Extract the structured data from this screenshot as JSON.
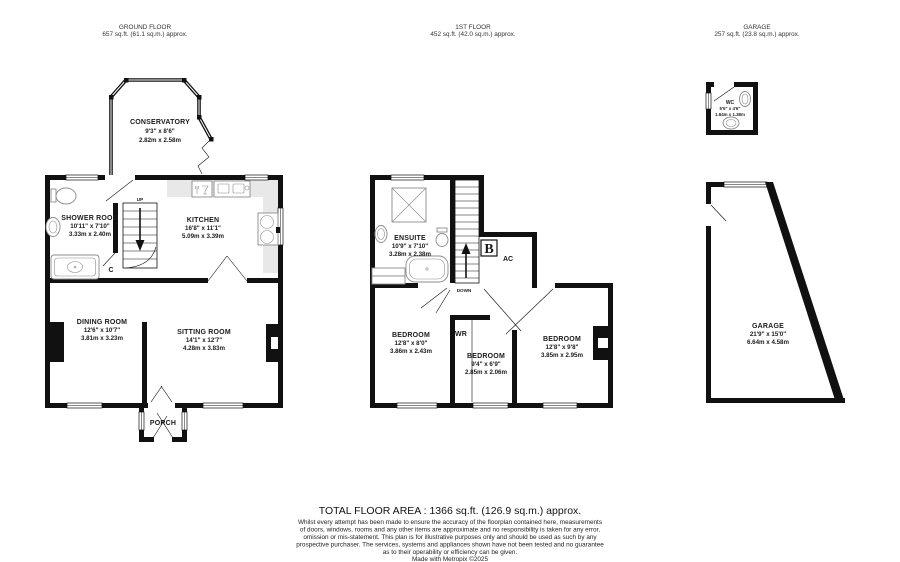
{
  "headers": [
    {
      "title": "GROUND FLOOR",
      "area": "657 sq.ft. (61.1 sq.m.) approx."
    },
    {
      "title": "1ST FLOOR",
      "area": "452 sq.ft. (42.0 sq.m.) approx."
    },
    {
      "title": "GARAGE",
      "area": "257 sq.ft. (23.8 sq.m.) approx."
    }
  ],
  "rooms": {
    "conservatory": {
      "name": "CONSERVATORY",
      "imperial": "9'3\" x 8'6\"",
      "metric": "2.82m x 2.58m"
    },
    "shower_room": {
      "name": "SHOWER ROOM",
      "imperial": "10'11\" x 7'10\"",
      "metric": "3.33m x 2.40m"
    },
    "kitchen": {
      "name": "KITCHEN",
      "imperial": "16'8\" x 11'1\"",
      "metric": "5.09m x 3.39m"
    },
    "dining_room": {
      "name": "DINING ROOM",
      "imperial": "12'6\" x 10'7\"",
      "metric": "3.81m x 3.23m"
    },
    "sitting_room": {
      "name": "SITTING ROOM",
      "imperial": "14'1\" x 12'7\"",
      "metric": "4.28m x 3.83m"
    },
    "porch": {
      "name": "PORCH"
    },
    "ensuite": {
      "name": "ENSUITE",
      "imperial": "10'9\" x 7'10\"",
      "metric": "3.28m x 2.38m"
    },
    "bedroom_left": {
      "name": "BEDROOM",
      "imperial": "12'8\" x 8'0\"",
      "metric": "3.86m x 2.43m"
    },
    "bedroom_middle": {
      "name": "BEDROOM",
      "imperial": "9'4\" x 6'9\"",
      "metric": "2.85m x 2.06m"
    },
    "bedroom_right": {
      "name": "BEDROOM",
      "imperial": "12'8\" x 9'8\"",
      "metric": "3.85m x 2.95m"
    },
    "wc": {
      "name": "WC",
      "imperial": "5'5\" x 4'6\"",
      "metric": "1.64m x 1.38m"
    },
    "garage": {
      "name": "GARAGE",
      "imperial": "21'9\" x 15'0\"",
      "metric": "6.64m x 4.58m"
    }
  },
  "annotations": {
    "up": "UP",
    "down": "DOWN",
    "cupboard": "C",
    "boiler": "B",
    "airing_cupboard": "AC",
    "wardrobe": "WR"
  },
  "footer": {
    "total_area": "TOTAL FLOOR AREA : 1366 sq.ft. (126.9 sq.m.) approx.",
    "disclaimer_lines": [
      "Whilst every attempt has been made to ensure the accuracy of the floorplan contained here, measurements",
      "of doors, windows, rooms and any other items are approximate and no responsibility is taken for any error,",
      "omission or mis-statement. This plan is for illustrative purposes only and should be used as such by any",
      "prospective purchaser. The services, systems and appliances shown have not been tested and no guarantee",
      "as to their operability or efficiency can be given."
    ],
    "credit": "Made with Metropix ©2025"
  },
  "colors": {
    "wall": "#111111",
    "counter": "#e8e8e8",
    "fixture": "#8c8c8c",
    "text": "#1a1a1a"
  }
}
